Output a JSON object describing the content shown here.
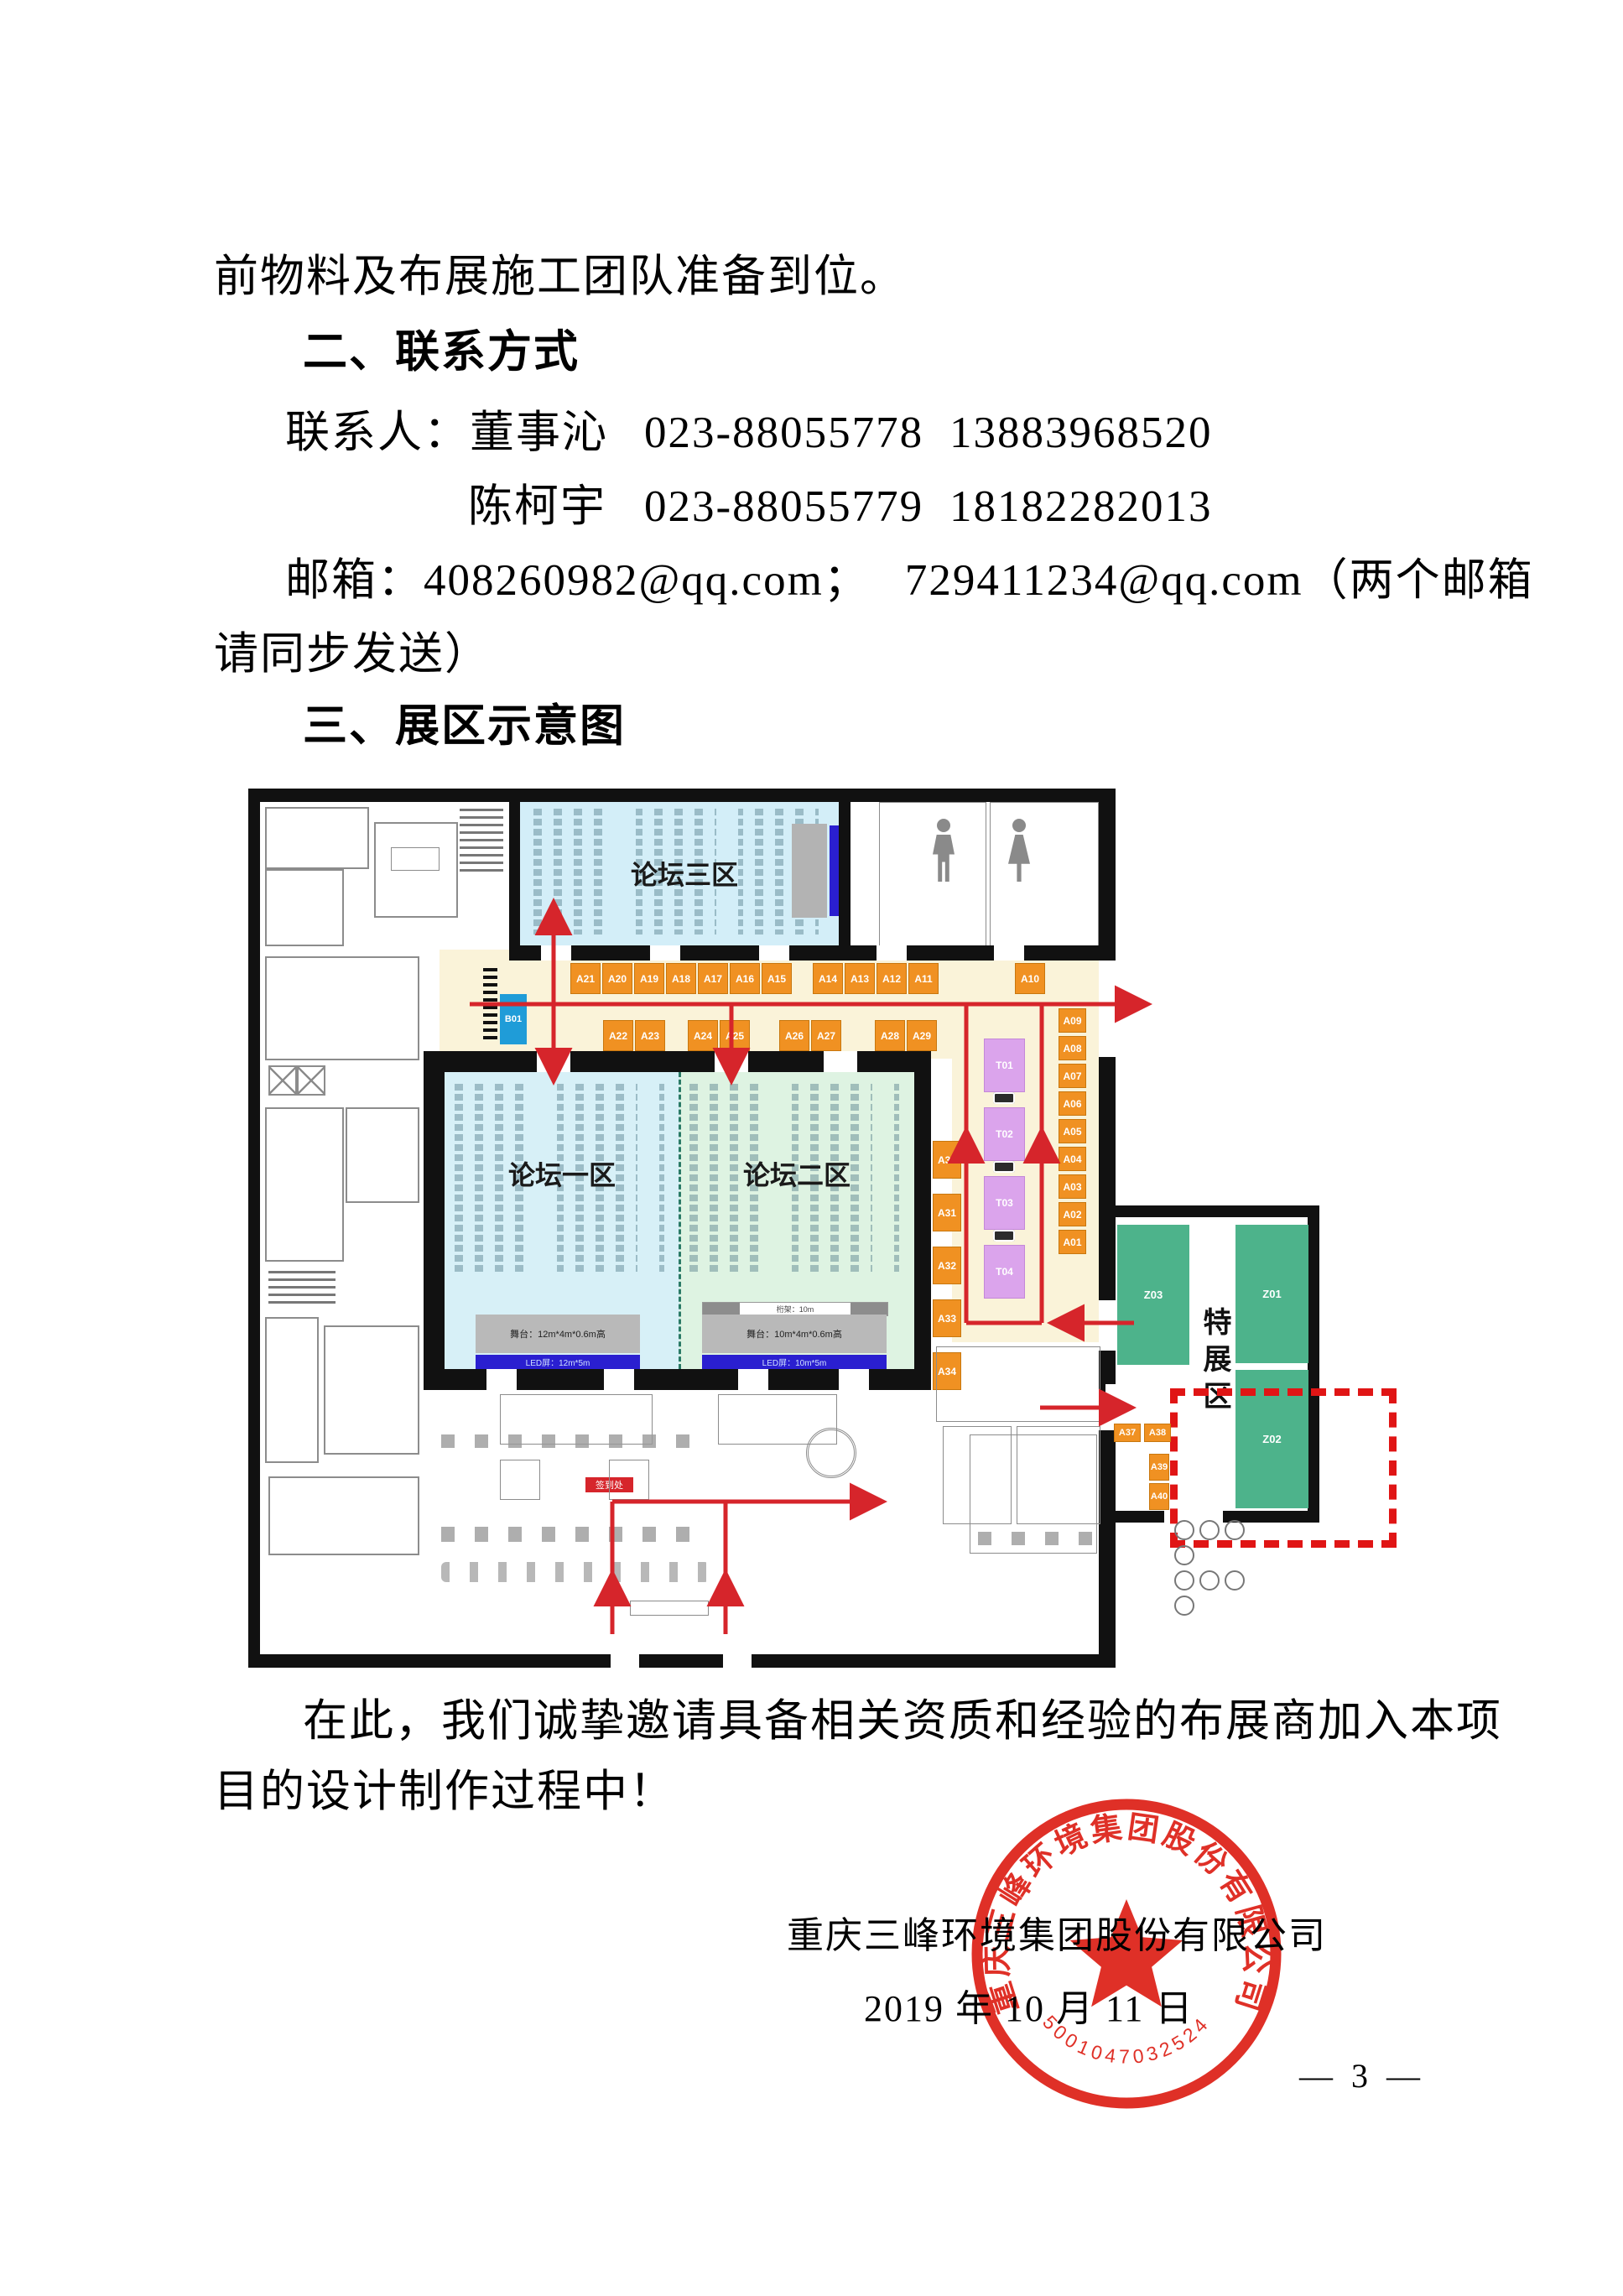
{
  "document": {
    "intro_tail": "前物料及布展施工团队准备到位。",
    "section2_heading": "二、联系方式",
    "contact_label": "联系人：",
    "contacts": [
      {
        "name": "董事沁",
        "tel": "023-88055778",
        "mobile": "13883968520"
      },
      {
        "name": "陈柯宇",
        "tel": "023-88055779",
        "mobile": "18182282013"
      }
    ],
    "email_line1": "邮箱：408260982@qq.com；",
    "email_line1b": "729411234@qq.com（两个邮箱",
    "email_line2": "请同步发送）",
    "section3_heading": "三、展区示意图",
    "closing_line1": "在此，我们诚挚邀请具备相关资质和经验的布展商加入本项",
    "closing_line2": "目的设计制作过程中！",
    "signature_company": "重庆三峰环境集团股份有限公司",
    "signature_date": "2019 年 10 月 11 日",
    "page_number": "— 3 —"
  },
  "stamp": {
    "ring_text": "重庆三峰环境集团股份有限公司",
    "serial": "5001047032524"
  },
  "floorplan": {
    "zones": {
      "forum1": "论坛一区",
      "forum2": "论坛二区",
      "forum3": "论坛三区",
      "special": "特展区"
    },
    "booths": {
      "top_row_1": [
        "A21",
        "A20",
        "A19",
        "A18",
        "A17",
        "A16",
        "A15"
      ],
      "top_row_2": [
        "A14",
        "A13",
        "A12",
        "A11"
      ],
      "top_row_3": [
        "A10"
      ],
      "bottom_row_1": [
        "A22",
        "A23"
      ],
      "bottom_row_2": [
        "A24",
        "A25"
      ],
      "bottom_row_3": [
        "A26",
        "A27"
      ],
      "bottom_row_4": [
        "A28",
        "A29"
      ],
      "right_col": [
        "A09",
        "A08",
        "A07",
        "A06",
        "A05",
        "A04",
        "A03",
        "A02",
        "A01"
      ],
      "side_col": [
        "A30",
        "A31",
        "A32",
        "A33",
        "A34"
      ],
      "annex_row": [
        "A37",
        "A38"
      ],
      "annex_col": [
        "A39",
        "A40"
      ],
      "t_col": [
        "T01",
        "T02",
        "T03",
        "T04"
      ],
      "special_z": [
        "Z03",
        "Z01",
        "Z02"
      ],
      "b_booth": "B01"
    },
    "stage_left": {
      "stage": "舞台：12m*4m*0.6m高",
      "led": "LED屏：12m*5m"
    },
    "stage_right": {
      "truss": "桁架：10m",
      "stage": "舞台：10m*4m*0.6m高",
      "led": "LED屏：10m*5m"
    },
    "signin_label": "签到处"
  },
  "colors": {
    "route_red": "#d6252b",
    "stamp_red": "#dd2016",
    "booth_orange": "#f09122",
    "booth_purple": "#dba4ec",
    "special_green": "#4db38b",
    "b01_blue": "#1f9cd8",
    "corridor_cream": "#faf3d9",
    "forum1_cyan": "#d7f0f7",
    "forum2_green": "#def3e2",
    "forum3_cyan": "#d3eef8",
    "led_blue": "#2a1fd0"
  }
}
